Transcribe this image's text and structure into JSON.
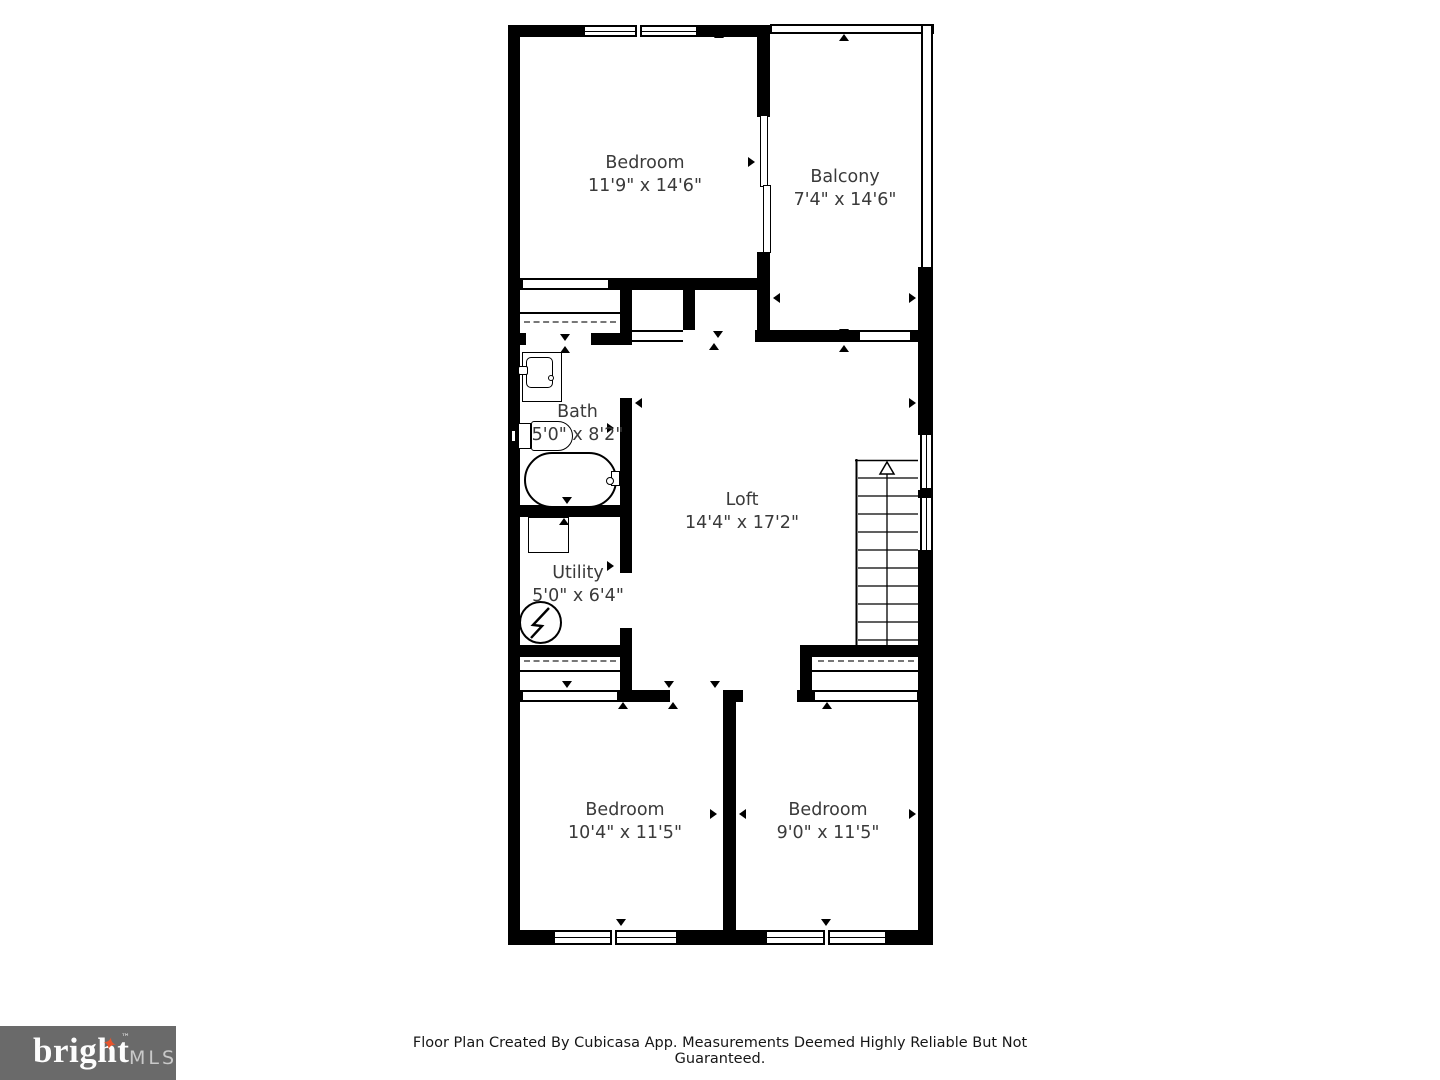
{
  "plan": {
    "rooms": [
      {
        "id": "bedroom-top",
        "name": "Bedroom",
        "dims": "11'9\" x 14'6\""
      },
      {
        "id": "balcony",
        "name": "Balcony",
        "dims": "7'4\" x 14'6\""
      },
      {
        "id": "bath",
        "name": "Bath",
        "dims": "5'0\" x 8'2\""
      },
      {
        "id": "loft",
        "name": "Loft",
        "dims": "14'4\" x 17'2\""
      },
      {
        "id": "utility",
        "name": "Utility",
        "dims": "5'0\" x 6'4\""
      },
      {
        "id": "bedroom-left",
        "name": "Bedroom",
        "dims": "10'4\" x 11'5\""
      },
      {
        "id": "bedroom-right",
        "name": "Bedroom",
        "dims": "9'0\" x 11'5\""
      }
    ],
    "features": [
      "staircase-up",
      "bathtub",
      "toilet",
      "sink",
      "water-heater",
      "electrical-panel",
      "sliding-door",
      "closets",
      "windows"
    ]
  },
  "footer": {
    "disclaimer": "Floor Plan Created By Cubicasa App. Measurements Deemed Highly Reliable But Not Guaranteed."
  },
  "logo": {
    "brand": "bright",
    "tm": "™",
    "suffix": "MLS"
  },
  "colors": {
    "wall": "#000000",
    "background": "#ffffff",
    "label_text": "#3a3a3a",
    "logo_background": "#6a6a6a",
    "logo_brand": "#fdfdfd",
    "logo_suffix": "#c9c9c9",
    "logo_star": "#e8542c"
  }
}
